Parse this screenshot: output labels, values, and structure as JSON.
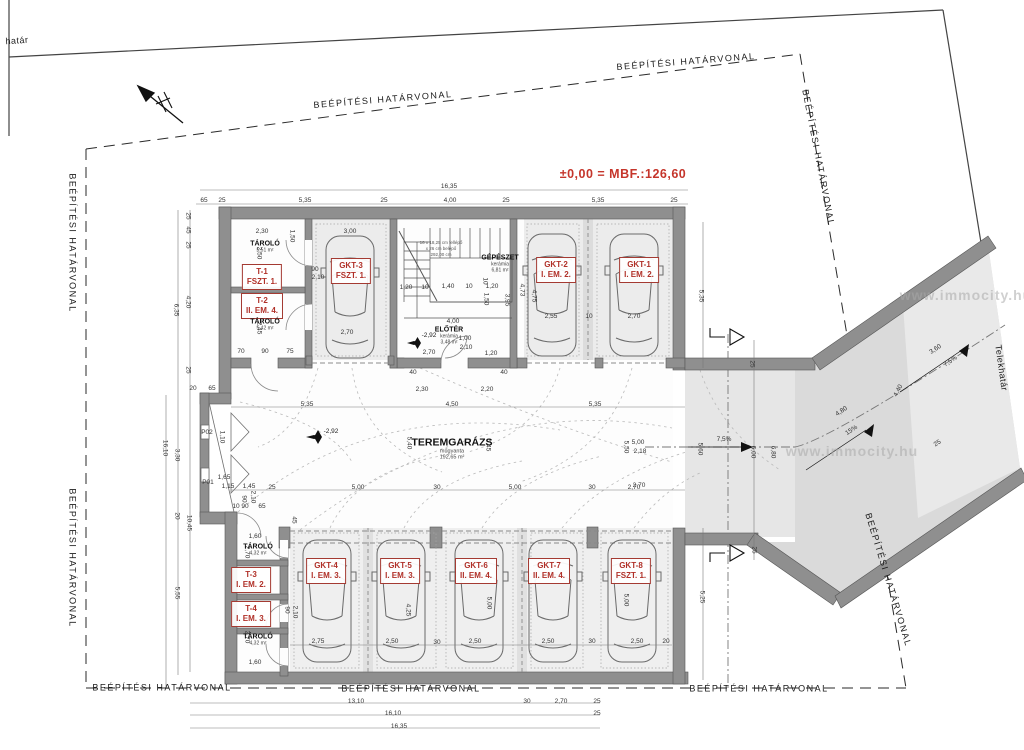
{
  "title": {
    "t": "±0,00 = MBF.:126,60",
    "x": 623,
    "y": 174
  },
  "boundary_labels": [
    {
      "t": "BEÉPÍTÉSI HATÁRVONAL",
      "x": 383,
      "y": 100,
      "r": -4.5
    },
    {
      "t": "BEÉPÍTÉSI HATÁRVONAL",
      "x": 686,
      "y": 62,
      "r": -4.5
    },
    {
      "t": "BEÉPÍTÉSI HATÁRVONAL",
      "x": 818,
      "y": 158,
      "r": 79
    },
    {
      "t": "BEÉPÍTÉSI HATÁRVONAL",
      "x": 888,
      "y": 580,
      "r": 73
    },
    {
      "t": "BEÉPÍTÉSI HATÁRVONAL",
      "x": 72,
      "y": 243,
      "r": 90
    },
    {
      "t": "BEÉPÍTÉSI HATÁRVONAL",
      "x": 72,
      "y": 558,
      "r": 90
    },
    {
      "t": "BEÉPÍTÉSI HATÁRVONAL",
      "x": 162,
      "y": 688,
      "r": 0
    },
    {
      "t": "BEÉPÍTÉSI HATÁRVONAL",
      "x": 411,
      "y": 689,
      "r": 0
    },
    {
      "t": "BEÉPÍTÉSI HATÁRVONAL",
      "x": 759,
      "y": 689,
      "r": 0
    }
  ],
  "site_labels": [
    {
      "t": "Telekhatár",
      "x": 1001,
      "y": 368,
      "r": 82
    },
    {
      "t": "határ",
      "x": 17,
      "y": 41,
      "r": -4
    }
  ],
  "units": [
    {
      "l1": "T-1",
      "l2": "FSZT. 1.",
      "x": 262,
      "y": 277
    },
    {
      "l1": "T-2",
      "l2": "II. EM. 4.",
      "x": 262,
      "y": 306
    },
    {
      "l1": "GKT-3",
      "l2": "FSZT. 1.",
      "x": 351,
      "y": 271
    },
    {
      "l1": "GKT-2",
      "l2": "I. EM. 2.",
      "x": 556,
      "y": 270
    },
    {
      "l1": "GKT-1",
      "l2": "I. EM. 2.",
      "x": 639,
      "y": 270
    },
    {
      "l1": "T-3",
      "l2": "I. EM. 2.",
      "x": 251,
      "y": 580
    },
    {
      "l1": "T-4",
      "l2": "I. EM. 3.",
      "x": 251,
      "y": 614
    },
    {
      "l1": "GKT-4",
      "l2": "I. EM. 3.",
      "x": 326,
      "y": 571
    },
    {
      "l1": "GKT-5",
      "l2": "I. EM. 3.",
      "x": 400,
      "y": 571
    },
    {
      "l1": "GKT-6",
      "l2": "II. EM. 4.",
      "x": 476,
      "y": 571
    },
    {
      "l1": "GKT-7",
      "l2": "II. EM. 4.",
      "x": 549,
      "y": 571
    },
    {
      "l1": "GKT-8",
      "l2": "FSZT. 1.",
      "x": 631,
      "y": 571
    }
  ],
  "rooms": [
    {
      "n": "TÁROLÓ",
      "s1": "5,51 m²",
      "x": 265,
      "y": 247,
      "big": false
    },
    {
      "n": "TÁROLÓ",
      "s1": "5,42 m²",
      "x": 265,
      "y": 325,
      "big": false
    },
    {
      "n": "GÉPÉSZET",
      "s1": "kerámia",
      "s2": "6,81 m²",
      "x": 500,
      "y": 264,
      "big": false
    },
    {
      "n": "ELŐTÉR",
      "s1": "kerámia",
      "s2": "3,48 m²",
      "x": 449,
      "y": 336,
      "big": false
    },
    {
      "n": "TEREMGARÁZS",
      "s1": "műgyanta",
      "s2": "192,65 m²",
      "x": 452,
      "y": 449,
      "big": true
    },
    {
      "n": "TÁROLÓ",
      "s1": "4,32 m²",
      "x": 258,
      "y": 550,
      "big": false
    },
    {
      "n": "TÁROLÓ",
      "s1": "4,32 m²",
      "x": 258,
      "y": 640,
      "big": false
    }
  ],
  "levels": [
    {
      "t": "-2,92",
      "x": 331,
      "y": 432
    },
    {
      "t": "-2,92",
      "x": 429,
      "y": 336
    }
  ],
  "stair_notes": [
    {
      "t": "16 x 18,25 cm fellépő",
      "x": 441,
      "y": 243
    },
    {
      "t": "x 26 cm belépő",
      "x": 441,
      "y": 249
    },
    {
      "t": "292,00 cm",
      "x": 441,
      "y": 255
    }
  ],
  "watermarks": [
    {
      "t": "www.immocity.hu",
      "x": 852,
      "y": 451
    },
    {
      "t": "www.immocity.hu",
      "x": 966,
      "y": 295
    }
  ],
  "dims": [
    {
      "t": "16,35",
      "x": 449,
      "y": 187
    },
    {
      "t": "65",
      "x": 204,
      "y": 201
    },
    {
      "t": "25",
      "x": 222,
      "y": 201
    },
    {
      "t": "5,35",
      "x": 305,
      "y": 201
    },
    {
      "t": "25",
      "x": 384,
      "y": 201
    },
    {
      "t": "4,00",
      "x": 450,
      "y": 201
    },
    {
      "t": "25",
      "x": 506,
      "y": 201
    },
    {
      "t": "5,35",
      "x": 598,
      "y": 201
    },
    {
      "t": "25",
      "x": 674,
      "y": 201
    },
    {
      "t": "25",
      "x": 187,
      "y": 216,
      "r": 90
    },
    {
      "t": "45",
      "x": 187,
      "y": 230,
      "r": 90
    },
    {
      "t": "25",
      "x": 187,
      "y": 245,
      "r": 90
    },
    {
      "t": "4,20",
      "x": 187,
      "y": 302,
      "r": 90
    },
    {
      "t": "6,35",
      "x": 175,
      "y": 310,
      "r": 90
    },
    {
      "t": "25",
      "x": 187,
      "y": 370,
      "r": 90
    },
    {
      "t": "2,50",
      "x": 258,
      "y": 253,
      "r": 90
    },
    {
      "t": "2,45",
      "x": 258,
      "y": 328,
      "r": 90
    },
    {
      "t": "1,50",
      "x": 291,
      "y": 236,
      "r": 90
    },
    {
      "t": "2,30",
      "x": 262,
      "y": 232
    },
    {
      "t": "3,00",
      "x": 350,
      "y": 232
    },
    {
      "t": "90",
      "x": 315,
      "y": 270
    },
    {
      "t": "2,10",
      "x": 318,
      "y": 278
    },
    {
      "t": "2,70",
      "x": 347,
      "y": 333
    },
    {
      "t": "70",
      "x": 241,
      "y": 352
    },
    {
      "t": "90",
      "x": 265,
      "y": 352
    },
    {
      "t": "75",
      "x": 290,
      "y": 352
    },
    {
      "t": "20",
      "x": 193,
      "y": 389
    },
    {
      "t": "65",
      "x": 212,
      "y": 389
    },
    {
      "t": "1,20",
      "x": 406,
      "y": 288
    },
    {
      "t": "10",
      "x": 425,
      "y": 288
    },
    {
      "t": "1,40",
      "x": 448,
      "y": 287
    },
    {
      "t": "10",
      "x": 469,
      "y": 287
    },
    {
      "t": "1,20",
      "x": 492,
      "y": 287
    },
    {
      "t": "1,50",
      "x": 485,
      "y": 299,
      "r": 90
    },
    {
      "t": "3,95",
      "x": 506,
      "y": 300,
      "r": 90
    },
    {
      "t": "4,75",
      "x": 533,
      "y": 296,
      "r": 90
    },
    {
      "t": "10",
      "x": 484,
      "y": 281,
      "r": 90
    },
    {
      "t": "4,00",
      "x": 453,
      "y": 322
    },
    {
      "t": "2,70",
      "x": 429,
      "y": 353
    },
    {
      "t": "1,00",
      "x": 465,
      "y": 339
    },
    {
      "t": "2,10",
      "x": 466,
      "y": 348
    },
    {
      "t": "1,20",
      "x": 491,
      "y": 354
    },
    {
      "t": "40",
      "x": 413,
      "y": 373
    },
    {
      "t": "40",
      "x": 504,
      "y": 373
    },
    {
      "t": "4,73",
      "x": 521,
      "y": 290,
      "r": 90
    },
    {
      "t": "2,55",
      "x": 551,
      "y": 317
    },
    {
      "t": "10",
      "x": 589,
      "y": 317
    },
    {
      "t": "2,70",
      "x": 634,
      "y": 317
    },
    {
      "t": "5,35",
      "x": 700,
      "y": 296,
      "r": 90
    },
    {
      "t": "5,35",
      "x": 307,
      "y": 405
    },
    {
      "t": "4,50",
      "x": 452,
      "y": 405
    },
    {
      "t": "5,35",
      "x": 595,
      "y": 405
    },
    {
      "t": "2,30",
      "x": 422,
      "y": 390
    },
    {
      "t": "2,20",
      "x": 487,
      "y": 390
    },
    {
      "t": "5,40",
      "x": 408,
      "y": 443,
      "r": 90
    },
    {
      "t": "5,45",
      "x": 487,
      "y": 445,
      "r": 90
    },
    {
      "t": "5,50",
      "x": 625,
      "y": 447,
      "r": 90
    },
    {
      "t": "5,00",
      "x": 638,
      "y": 443
    },
    {
      "t": "2,18",
      "x": 640,
      "y": 452
    },
    {
      "t": "2,70",
      "x": 639,
      "y": 486
    },
    {
      "t": "5,00",
      "x": 358,
      "y": 488
    },
    {
      "t": "30",
      "x": 437,
      "y": 488
    },
    {
      "t": "5,00",
      "x": 515,
      "y": 488
    },
    {
      "t": "30",
      "x": 592,
      "y": 488
    },
    {
      "t": "2,70",
      "x": 634,
      "y": 488
    },
    {
      "t": "P02",
      "x": 207,
      "y": 433
    },
    {
      "t": "P01",
      "x": 208,
      "y": 483
    },
    {
      "t": "1,10",
      "x": 221,
      "y": 437,
      "r": 90
    },
    {
      "t": "1,65",
      "x": 224,
      "y": 478
    },
    {
      "t": "1,15",
      "x": 228,
      "y": 487
    },
    {
      "t": "1,45",
      "x": 249,
      "y": 487
    },
    {
      "t": "25",
      "x": 272,
      "y": 488
    },
    {
      "t": "90",
      "x": 243,
      "y": 499,
      "r": 90
    },
    {
      "t": "2,10",
      "x": 252,
      "y": 497,
      "r": 90
    },
    {
      "t": "10",
      "x": 236,
      "y": 507
    },
    {
      "t": "90",
      "x": 245,
      "y": 507
    },
    {
      "t": "65",
      "x": 262,
      "y": 507
    },
    {
      "t": "16,10",
      "x": 164,
      "y": 448,
      "r": 90
    },
    {
      "t": "3,30",
      "x": 176,
      "y": 455,
      "r": 90
    },
    {
      "t": "20",
      "x": 176,
      "y": 516,
      "r": 90
    },
    {
      "t": "10,45",
      "x": 188,
      "y": 523,
      "r": 90
    },
    {
      "t": "5,55",
      "x": 176,
      "y": 593,
      "r": 90
    },
    {
      "t": "1,60",
      "x": 255,
      "y": 537
    },
    {
      "t": "2,70",
      "x": 246,
      "y": 552,
      "r": 90
    },
    {
      "t": "45",
      "x": 293,
      "y": 520,
      "r": 90
    },
    {
      "t": "90",
      "x": 286,
      "y": 610,
      "r": 90
    },
    {
      "t": "2,10",
      "x": 294,
      "y": 612,
      "r": 90
    },
    {
      "t": "1,60",
      "x": 255,
      "y": 663
    },
    {
      "t": "2,70",
      "x": 246,
      "y": 637,
      "r": 90
    },
    {
      "t": "2,75",
      "x": 318,
      "y": 642
    },
    {
      "t": "2,50",
      "x": 392,
      "y": 642
    },
    {
      "t": "30",
      "x": 437,
      "y": 643
    },
    {
      "t": "2,50",
      "x": 475,
      "y": 642
    },
    {
      "t": "2,50",
      "x": 548,
      "y": 642
    },
    {
      "t": "30",
      "x": 592,
      "y": 642
    },
    {
      "t": "2,50",
      "x": 637,
      "y": 642
    },
    {
      "t": "20",
      "x": 666,
      "y": 642
    },
    {
      "t": "4,25",
      "x": 407,
      "y": 610,
      "r": 90
    },
    {
      "t": "5,00",
      "x": 488,
      "y": 603,
      "r": 90
    },
    {
      "t": "5,00",
      "x": 625,
      "y": 600,
      "r": 90
    },
    {
      "t": "5,25",
      "x": 701,
      "y": 597,
      "r": 90
    },
    {
      "t": "5,60",
      "x": 699,
      "y": 449,
      "r": 90
    },
    {
      "t": "6,00",
      "x": 752,
      "y": 452,
      "r": 90
    },
    {
      "t": "6,80",
      "x": 772,
      "y": 452,
      "r": 90
    },
    {
      "t": "25",
      "x": 751,
      "y": 364,
      "r": 90
    },
    {
      "t": "25",
      "x": 753,
      "y": 550,
      "r": 90
    },
    {
      "t": "4,80",
      "x": 842,
      "y": 412,
      "r": -34
    },
    {
      "t": "3,60",
      "x": 936,
      "y": 350,
      "r": -34
    },
    {
      "t": "4,40",
      "x": 899,
      "y": 391,
      "r": -62
    },
    {
      "t": "25",
      "x": 938,
      "y": 444,
      "r": -34
    },
    {
      "t": "13,10",
      "x": 356,
      "y": 702
    },
    {
      "t": "30",
      "x": 527,
      "y": 702
    },
    {
      "t": "2,70",
      "x": 561,
      "y": 702
    },
    {
      "t": "25",
      "x": 597,
      "y": 702
    },
    {
      "t": "16,10",
      "x": 393,
      "y": 714
    },
    {
      "t": "25",
      "x": 597,
      "y": 714
    },
    {
      "t": "16,35",
      "x": 399,
      "y": 727
    }
  ],
  "slopes": [
    {
      "t": "7,5%",
      "x": 724,
      "y": 440,
      "r": 0
    },
    {
      "t": "15%",
      "x": 852,
      "y": 431,
      "r": -34
    },
    {
      "t": "7,5%",
      "x": 951,
      "y": 362,
      "r": -34
    }
  ]
}
